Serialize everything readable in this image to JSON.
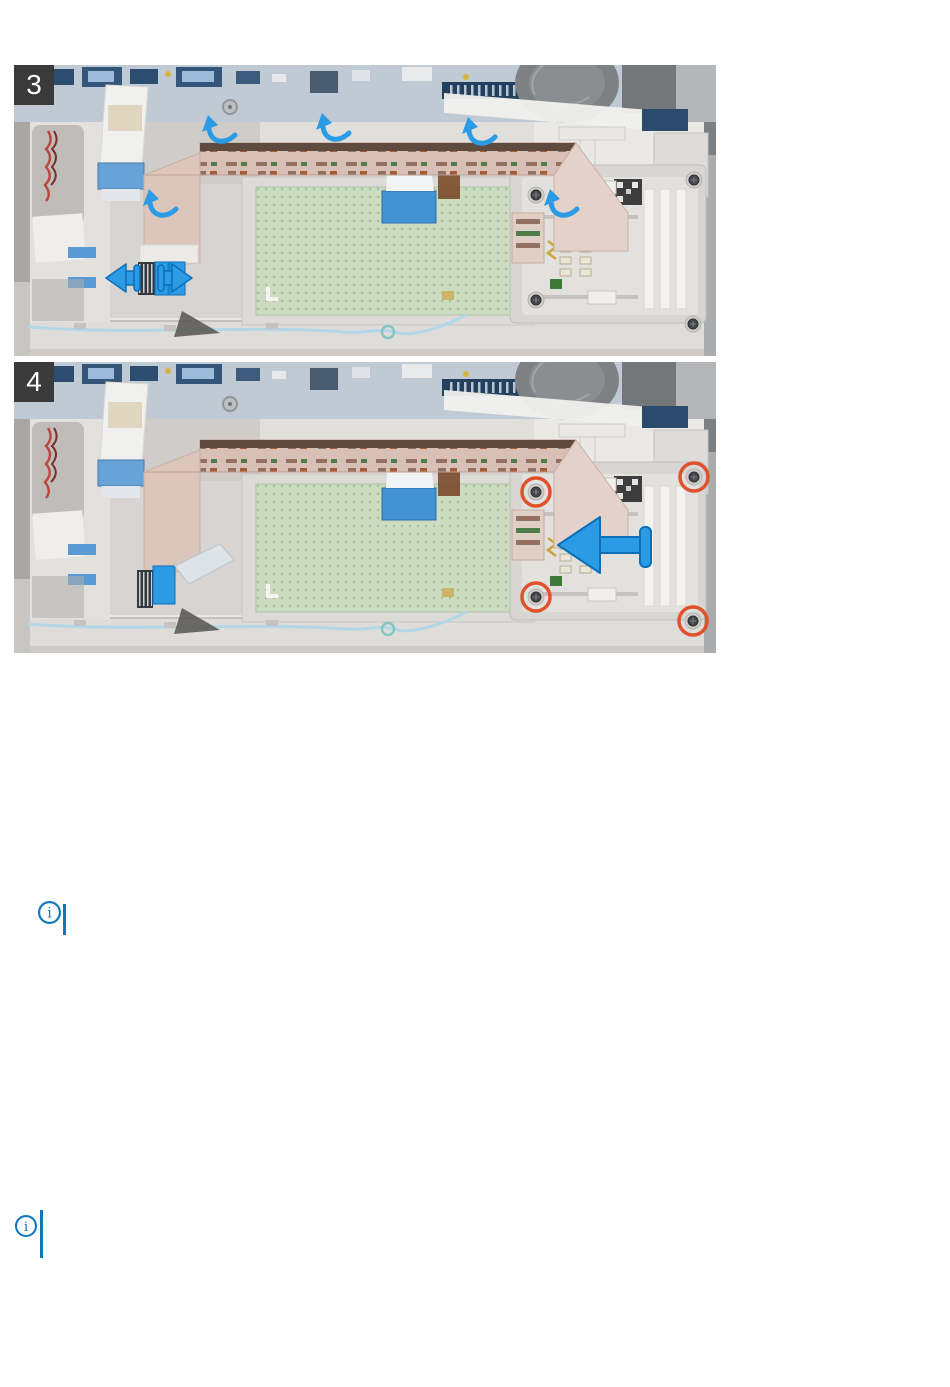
{
  "page": {
    "background": "#ffffff",
    "content": "two step illustrations followed by two empty note callouts"
  },
  "steps": [
    {
      "badge": "3",
      "alt": "Peel the smart-card-reader flat cable and disconnect it from the connector",
      "callouts": {
        "peel_arrows": 5,
        "connector_arrows": 2
      }
    },
    {
      "badge": "4",
      "alt": "Remove the four screws and slide the smart-card reader out",
      "callouts": {
        "screw_circles": 4,
        "removal_arrows": 1
      }
    }
  ],
  "notes": [
    {
      "icon": "info-icon",
      "glyph": "i",
      "text": ""
    },
    {
      "icon": "info-icon",
      "glyph": "i",
      "text": ""
    }
  ],
  "colors": {
    "callout_blue": "#2b9be6",
    "callout_blue_outline": "#0c6fb8",
    "screw_circle_red": "#e0522d",
    "note_blue": "#1377be",
    "badge_background": "#3a3a3b",
    "badge_text": "#ffffff",
    "touchpad_green": "#ccdcc1",
    "ribbon_tan": "#d8c0b6"
  }
}
